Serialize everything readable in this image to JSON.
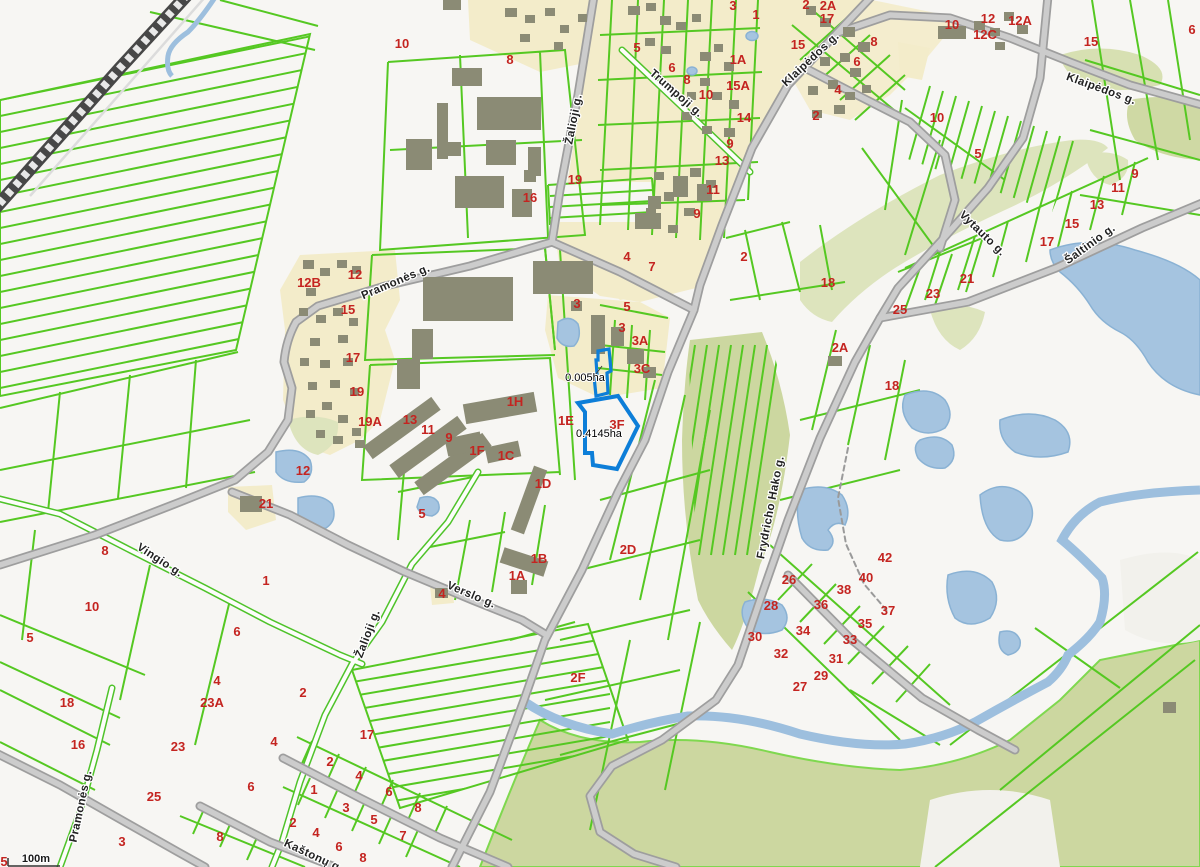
{
  "map": {
    "scale_label": "100m",
    "colors": {
      "parcel_line": "#55c822",
      "road_fill": "#c9c9c9",
      "road_casing": "#9e9e9e",
      "railway": "#474747",
      "water": "#a5c4e0",
      "building": "#8b8b75",
      "residential_area": "#f3ecca",
      "park_area": "#cfd9a4",
      "selection_outline": "#0d7ed8",
      "parcel_number_text": "#c42420",
      "street_text": "#222222",
      "background": "#f7f6f3"
    },
    "selected_parcels": [
      {
        "area_label": "0.005ha"
      },
      {
        "area_label": "0.4145ha"
      }
    ],
    "area_labels": [
      [
        "0.005ha",
        585,
        381
      ],
      [
        "0.4145ha",
        599,
        437
      ]
    ],
    "street_labels": [
      [
        "Žalioji g.",
        577,
        120,
        -79
      ],
      [
        "Trumpoji g.",
        674,
        96,
        41
      ],
      [
        "Klaipėdos g.",
        813,
        62,
        -43
      ],
      [
        "Klaipėdos g.",
        1100,
        92,
        20
      ],
      [
        "Pramonės g.",
        397,
        285,
        -23
      ],
      [
        "Vytauto g.",
        980,
        236,
        44
      ],
      [
        "Šaltinio g.",
        1092,
        247,
        -36
      ],
      [
        "Frydricho Hako g.",
        774,
        508,
        -79
      ],
      [
        "Vingio g.",
        158,
        563,
        33
      ],
      [
        "Verslo g.",
        470,
        598,
        23
      ],
      [
        "Žalioji g.",
        371,
        635,
        -69
      ],
      [
        "Pramonės g.",
        84,
        807,
        -78
      ],
      [
        "Kaštonų g.",
        312,
        859,
        25
      ]
    ],
    "parcel_numbers": [
      [
        "10",
        402,
        48
      ],
      [
        "8",
        510,
        64
      ],
      [
        "16",
        530,
        202
      ],
      [
        "19",
        575,
        184
      ],
      [
        "5",
        637,
        52
      ],
      [
        "6",
        672,
        72
      ],
      [
        "8",
        687,
        84
      ],
      [
        "10",
        706,
        99
      ],
      [
        "3",
        733,
        10
      ],
      [
        "1",
        756,
        19
      ],
      [
        "1A",
        738,
        64
      ],
      [
        "15A",
        738,
        90
      ],
      [
        "14",
        744,
        122
      ],
      [
        "9",
        730,
        148
      ],
      [
        "13",
        722,
        165
      ],
      [
        "11",
        713,
        194
      ],
      [
        "9",
        697,
        218
      ],
      [
        "2",
        806,
        9
      ],
      [
        "2A",
        828,
        10
      ],
      [
        "17",
        827,
        23
      ],
      [
        "15",
        798,
        49
      ],
      [
        "8",
        874,
        46
      ],
      [
        "6",
        857,
        66
      ],
      [
        "4",
        838,
        94
      ],
      [
        "2",
        816,
        120
      ],
      [
        "10",
        952,
        29
      ],
      [
        "12",
        988,
        23
      ],
      [
        "12C",
        985,
        39
      ],
      [
        "12A",
        1020,
        25
      ],
      [
        "15",
        1091,
        46
      ],
      [
        "6",
        1192,
        34
      ],
      [
        "10",
        937,
        122
      ],
      [
        "5",
        978,
        158
      ],
      [
        "9",
        1135,
        178
      ],
      [
        "11",
        1118,
        192
      ],
      [
        "13",
        1097,
        209
      ],
      [
        "15",
        1072,
        228
      ],
      [
        "17",
        1047,
        246
      ],
      [
        "21",
        967,
        283
      ],
      [
        "23",
        933,
        298
      ],
      [
        "25",
        900,
        314
      ],
      [
        "2",
        744,
        261
      ],
      [
        "18",
        828,
        287
      ],
      [
        "2A",
        840,
        352
      ],
      [
        "18",
        892,
        390
      ],
      [
        "4",
        627,
        261
      ],
      [
        "7",
        652,
        271
      ],
      [
        "3",
        577,
        308
      ],
      [
        "5",
        627,
        311
      ],
      [
        "3",
        622,
        332
      ],
      [
        "3A",
        640,
        345
      ],
      [
        "3C",
        642,
        373
      ],
      [
        "3F",
        617,
        429
      ],
      [
        "1E",
        566,
        425
      ],
      [
        "12B",
        309,
        287
      ],
      [
        "12",
        355,
        279
      ],
      [
        "15",
        348,
        314
      ],
      [
        "17",
        353,
        362
      ],
      [
        "19",
        357,
        396
      ],
      [
        "19A",
        370,
        426
      ],
      [
        "13",
        410,
        424
      ],
      [
        "11",
        428,
        434
      ],
      [
        "9",
        449,
        442
      ],
      [
        "1F",
        477,
        455
      ],
      [
        "1C",
        506,
        460
      ],
      [
        "1H",
        515,
        406
      ],
      [
        "12",
        303,
        475
      ],
      [
        "21",
        266,
        508
      ],
      [
        "5",
        422,
        518
      ],
      [
        "1D",
        543,
        488
      ],
      [
        "1B",
        539,
        563
      ],
      [
        "1A",
        517,
        580
      ],
      [
        "4",
        442,
        598
      ],
      [
        "2D",
        628,
        554
      ],
      [
        "2F",
        578,
        682
      ],
      [
        "8",
        105,
        555
      ],
      [
        "10",
        92,
        611
      ],
      [
        "5",
        30,
        642
      ],
      [
        "18",
        67,
        707
      ],
      [
        "16",
        78,
        749
      ],
      [
        "1",
        266,
        585
      ],
      [
        "6",
        237,
        636
      ],
      [
        "4",
        217,
        685
      ],
      [
        "23A",
        212,
        707
      ],
      [
        "2",
        303,
        697
      ],
      [
        "23",
        178,
        751
      ],
      [
        "4",
        274,
        746
      ],
      [
        "25",
        154,
        801
      ],
      [
        "3",
        122,
        846
      ],
      [
        "6",
        251,
        791
      ],
      [
        "8",
        220,
        841
      ],
      [
        "1",
        314,
        794
      ],
      [
        "2",
        293,
        827
      ],
      [
        "4",
        316,
        837
      ],
      [
        "6",
        339,
        851
      ],
      [
        "8",
        363,
        862
      ],
      [
        "3",
        346,
        812
      ],
      [
        "5",
        374,
        824
      ],
      [
        "7",
        403,
        840
      ],
      [
        "17",
        367,
        739
      ],
      [
        "2",
        330,
        766
      ],
      [
        "4",
        359,
        780
      ],
      [
        "6",
        389,
        796
      ],
      [
        "8",
        418,
        812
      ],
      [
        "5",
        4,
        866
      ],
      [
        "26",
        789,
        584
      ],
      [
        "28",
        771,
        610
      ],
      [
        "30",
        755,
        641
      ],
      [
        "32",
        781,
        658
      ],
      [
        "34",
        803,
        635
      ],
      [
        "36",
        821,
        609
      ],
      [
        "38",
        844,
        594
      ],
      [
        "40",
        866,
        582
      ],
      [
        "42",
        885,
        562
      ],
      [
        "37",
        888,
        615
      ],
      [
        "35",
        865,
        628
      ],
      [
        "33",
        850,
        644
      ],
      [
        "31",
        836,
        663
      ],
      [
        "29",
        821,
        680
      ],
      [
        "27",
        800,
        691
      ]
    ]
  }
}
